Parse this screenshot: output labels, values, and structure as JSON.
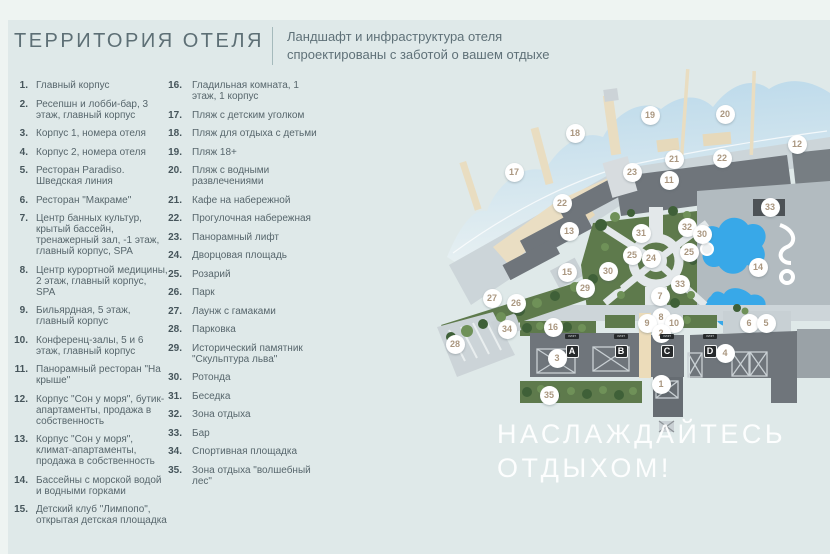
{
  "header": {
    "title": "ТЕРРИТОРИЯ ОТЕЛЯ",
    "subtitle_line1": "Ландшафт и инфраструктура отеля",
    "subtitle_line2": "спроектированы с заботой о вашем отдыхе"
  },
  "legend": {
    "column1": [
      {
        "n": "1.",
        "t": "Главный корпус"
      },
      {
        "n": "2.",
        "t": "Ресепшн и лобби-бар, 3 этаж, главный корпус"
      },
      {
        "n": "3.",
        "t": "Корпус 1, номера отеля"
      },
      {
        "n": "4.",
        "t": "Корпус 2, номера отеля"
      },
      {
        "n": "5.",
        "t": "Ресторан Paradiso. Шведская линия"
      },
      {
        "n": "6.",
        "t": "Ресторан \"Макраме\""
      },
      {
        "n": "7.",
        "t": "Центр банных культур, крытый бассейн, тренажерный зал, -1 этаж, главный корпус, SPA"
      },
      {
        "n": "8.",
        "t": "Центр курортной медицины, 2 этаж, главный корпус, SPA"
      },
      {
        "n": "9.",
        "t": "Бильярдная, 5 этаж, главный корпус"
      },
      {
        "n": "10.",
        "t": "Конференц-залы, 5 и 6 этаж, главный корпус"
      },
      {
        "n": "11.",
        "t": "Панорамный ресторан \"На крыше\""
      },
      {
        "n": "12.",
        "t": "Корпус \"Сон у моря\", бутик-апартаменты, продажа в собственность"
      },
      {
        "n": "13.",
        "t": "Корпус \"Сон у моря\", климат-апартаменты, продажа в собственность"
      },
      {
        "n": "14.",
        "t": "Бассейны с морской водой и водными горками"
      },
      {
        "n": "15.",
        "t": "Детский клуб \"Лимпопо\", открытая детская площадка"
      }
    ],
    "column2": [
      {
        "n": "16.",
        "t": "Гладильная комната, 1 этаж, 1 корпус"
      },
      {
        "n": "17.",
        "t": "Пляж с детским уголком"
      },
      {
        "n": "18.",
        "t": "Пляж для отдыха с детьми"
      },
      {
        "n": "19.",
        "t": "Пляж 18+"
      },
      {
        "n": "20.",
        "t": "Пляж с водными развлечениями"
      },
      {
        "n": "21.",
        "t": "Кафе на набережной"
      },
      {
        "n": "22.",
        "t": "Прогулочная набережная"
      },
      {
        "n": "23.",
        "t": "Панорамный лифт"
      },
      {
        "n": "24.",
        "t": "Дворцовая площадь"
      },
      {
        "n": "25.",
        "t": "Розарий"
      },
      {
        "n": "26.",
        "t": "Парк"
      },
      {
        "n": "27.",
        "t": "Лаунж с гамаками"
      },
      {
        "n": "28.",
        "t": "Парковка"
      },
      {
        "n": "29.",
        "t": "Исторический памятник \"Скульптура льва\""
      },
      {
        "n": "30.",
        "t": "Ротонда"
      },
      {
        "n": "31.",
        "t": "Беседка"
      },
      {
        "n": "32.",
        "t": "Зона отдыха"
      },
      {
        "n": "33.",
        "t": "Бар"
      },
      {
        "n": "34.",
        "t": "Спортивная площадка"
      },
      {
        "n": "35.",
        "t": "Зона отдыха \"волшебный лес\""
      }
    ]
  },
  "map": {
    "overlay_line1": "НАСЛАЖДАЙТЕСЬ",
    "overlay_line2": "ОТДЫХОМ!",
    "lift_label": "ЛИФТ",
    "letters": [
      {
        "ch": "A",
        "x": 137,
        "y": 286
      },
      {
        "ch": "B",
        "x": 186,
        "y": 286
      },
      {
        "ch": "C",
        "x": 232,
        "y": 286
      },
      {
        "ch": "D",
        "x": 275,
        "y": 286
      }
    ],
    "markers": [
      {
        "n": "17",
        "x": 79,
        "y": 107
      },
      {
        "n": "18",
        "x": 140,
        "y": 68
      },
      {
        "n": "19",
        "x": 215,
        "y": 50
      },
      {
        "n": "20",
        "x": 290,
        "y": 49
      },
      {
        "n": "12",
        "x": 362,
        "y": 79
      },
      {
        "n": "21",
        "x": 239,
        "y": 94
      },
      {
        "n": "22",
        "x": 287,
        "y": 93
      },
      {
        "n": "23",
        "x": 197,
        "y": 107
      },
      {
        "n": "11",
        "x": 234,
        "y": 115
      },
      {
        "n": "22",
        "x": 127,
        "y": 138
      },
      {
        "n": "33",
        "x": 335,
        "y": 142
      },
      {
        "n": "13",
        "x": 134,
        "y": 166
      },
      {
        "n": "31",
        "x": 206,
        "y": 168
      },
      {
        "n": "32",
        "x": 252,
        "y": 162
      },
      {
        "n": "30",
        "x": 267,
        "y": 169
      },
      {
        "n": "25",
        "x": 197,
        "y": 190
      },
      {
        "n": "24",
        "x": 216,
        "y": 193
      },
      {
        "n": "25",
        "x": 254,
        "y": 187
      },
      {
        "n": "15",
        "x": 132,
        "y": 207
      },
      {
        "n": "30",
        "x": 173,
        "y": 206
      },
      {
        "n": "14",
        "x": 323,
        "y": 202
      },
      {
        "n": "29",
        "x": 150,
        "y": 223
      },
      {
        "n": "33",
        "x": 245,
        "y": 219
      },
      {
        "n": "27",
        "x": 57,
        "y": 233
      },
      {
        "n": "26",
        "x": 81,
        "y": 238
      },
      {
        "n": "7",
        "x": 225,
        "y": 231
      },
      {
        "n": "8",
        "x": 226,
        "y": 252
      },
      {
        "n": "9",
        "x": 212,
        "y": 258
      },
      {
        "n": "10",
        "x": 239,
        "y": 258
      },
      {
        "n": "2",
        "x": 226,
        "y": 268
      },
      {
        "n": "6",
        "x": 314,
        "y": 258
      },
      {
        "n": "5",
        "x": 331,
        "y": 258
      },
      {
        "n": "16",
        "x": 118,
        "y": 262
      },
      {
        "n": "34",
        "x": 72,
        "y": 264
      },
      {
        "n": "28",
        "x": 20,
        "y": 279
      },
      {
        "n": "3",
        "x": 122,
        "y": 293
      },
      {
        "n": "4",
        "x": 290,
        "y": 288
      },
      {
        "n": "1",
        "x": 226,
        "y": 319
      },
      {
        "n": "35",
        "x": 114,
        "y": 330
      }
    ],
    "colors": {
      "building": "#6f757b",
      "green": "#5e7a4c",
      "pool": "#38a8e8",
      "marker": "#aa9780",
      "water": "#b9d8ea"
    }
  }
}
